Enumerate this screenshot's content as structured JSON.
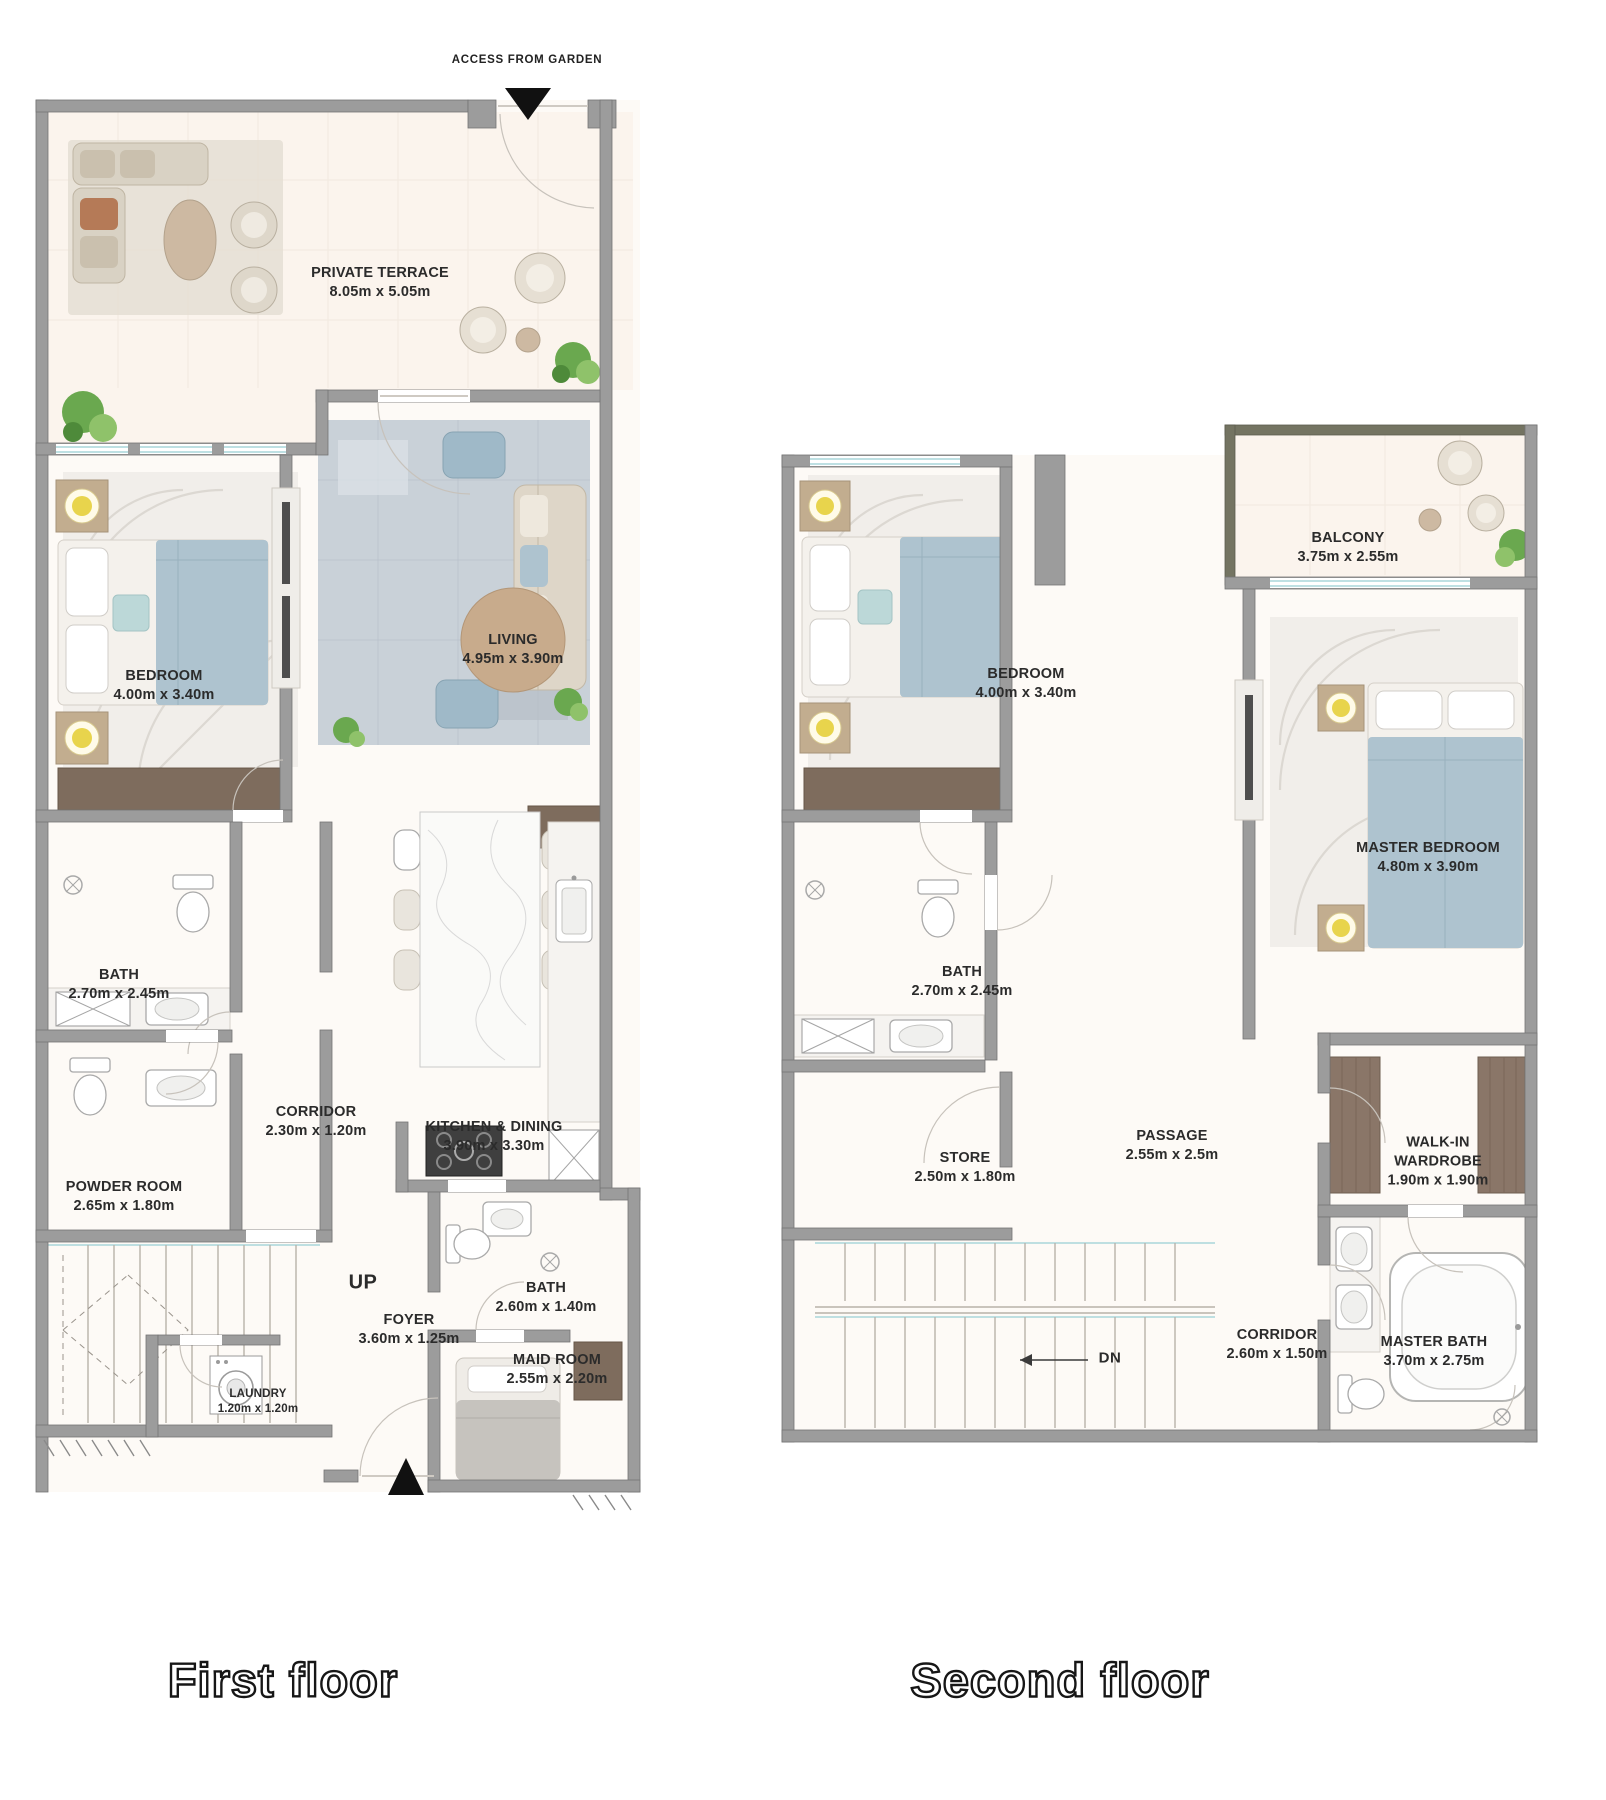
{
  "page": {
    "background": "#ffffff"
  },
  "colors": {
    "wall": "#9c9c9c",
    "balcony_wall": "#747462",
    "floor": "#fdfaf6",
    "terrace_floor": "#fbf4ed",
    "wood_brown": "#7e6c5d",
    "closet_brown": "#8a7668",
    "blue_fabric": "#aec3cf",
    "beige_sofa": "#d9d2c4",
    "round_table_tan": "#c8ab8c",
    "lamp_yellow": "#e8d44c",
    "plant_green": "#6aa84f",
    "window_teal": "#a9d6da",
    "label_text": "#2b2b2b"
  },
  "first_floor": {
    "caption": "First floor",
    "access_label": "ACCESS FROM GARDEN",
    "stairs_label": "UP",
    "rooms": {
      "terrace": {
        "name": "PRIVATE TERRACE",
        "dims": "8.05m x 5.05m"
      },
      "bedroom": {
        "name": "BEDROOM",
        "dims": "4.00m x 3.40m"
      },
      "living": {
        "name": "LIVING",
        "dims": "4.95m x 3.90m"
      },
      "bath": {
        "name": "BATH",
        "dims": "2.70m x 2.45m"
      },
      "corridor": {
        "name": "CORRIDOR",
        "dims": "2.30m x 1.20m"
      },
      "kitchen": {
        "name": "KITCHEN & DINING",
        "dims": "3.90m x 3.30m"
      },
      "powder": {
        "name": "POWDER ROOM",
        "dims": "2.65m x 1.80m"
      },
      "foyer": {
        "name": "FOYER",
        "dims": "3.60m x 1.25m"
      },
      "laundry": {
        "name": "LAUNDRY",
        "dims": "1.20m x 1.20m"
      },
      "bath2": {
        "name": "BATH",
        "dims": "2.60m x 1.40m"
      },
      "maid": {
        "name": "MAID ROOM",
        "dims": "2.55m x 2.20m"
      }
    }
  },
  "second_floor": {
    "caption": "Second floor",
    "stairs_label": "DN",
    "rooms": {
      "balcony": {
        "name": "BALCONY",
        "dims": "3.75m x 2.55m"
      },
      "bedroom": {
        "name": "BEDROOM",
        "dims": "4.00m x 3.40m"
      },
      "master": {
        "name": "MASTER BEDROOM",
        "dims": "4.80m x 3.90m"
      },
      "bath": {
        "name": "BATH",
        "dims": "2.70m x 2.45m"
      },
      "store": {
        "name": "STORE",
        "dims": "2.50m x 1.80m"
      },
      "passage": {
        "name": "PASSAGE",
        "dims": "2.55m x 2.5m"
      },
      "wardrobe": {
        "name": "WALK-IN WARDROBE",
        "dims": "1.90m x 1.90m"
      },
      "corridor": {
        "name": "CORRIDOR",
        "dims": "2.60m x 1.50m"
      },
      "masterbath": {
        "name": "MASTER BATH",
        "dims": "3.70m x 2.75m"
      }
    }
  }
}
